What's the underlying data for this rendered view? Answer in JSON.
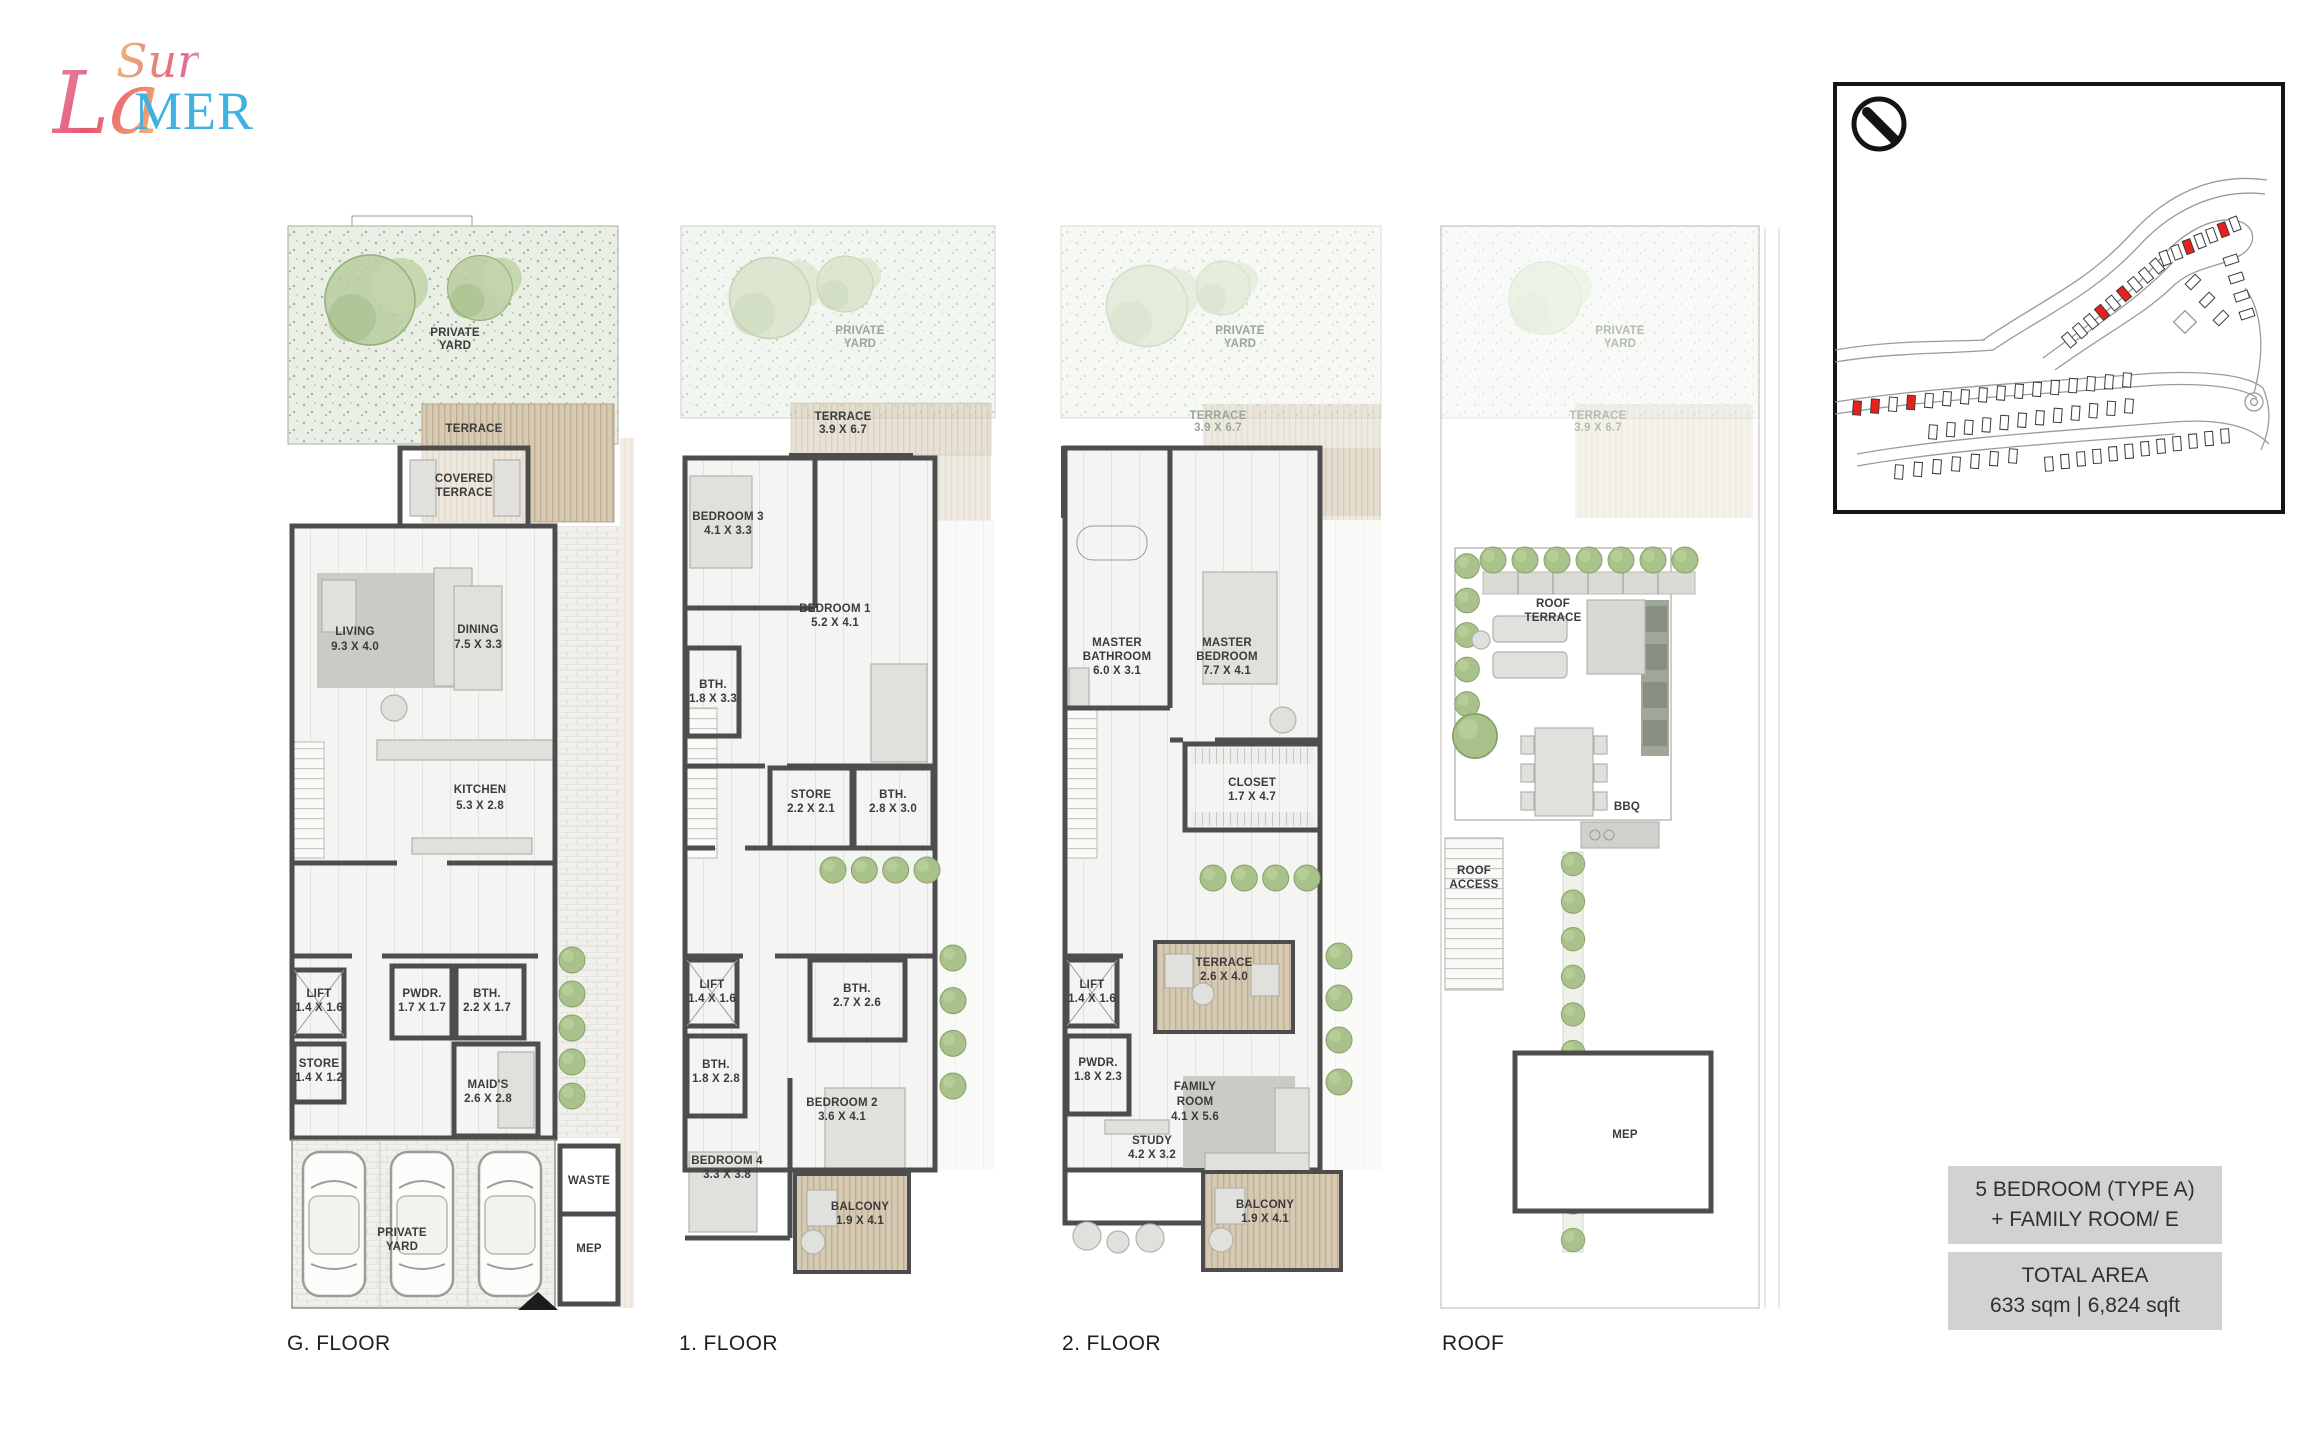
{
  "logo": {
    "sur": "Sur",
    "la": "La",
    "mer": "MER"
  },
  "plans": [
    {
      "floor_label": "G. FLOOR",
      "rooms": {
        "private_yard_top": {
          "l1": "PRIVATE",
          "l2": "YARD"
        },
        "terrace": {
          "l1": "TERRACE"
        },
        "covered_terrace": {
          "l1": "COVERED",
          "l2": "TERRACE"
        },
        "living": {
          "l1": "LIVING",
          "d": "9.3 X 4.0"
        },
        "dining": {
          "l1": "DINING",
          "d": "7.5 X 3.3"
        },
        "kitchen": {
          "l1": "KITCHEN",
          "d": "5.3 X 2.8"
        },
        "lift": {
          "l1": "LIFT",
          "d": "1.4 X 1.6"
        },
        "store": {
          "l1": "STORE",
          "d": "1.4 X 1.2"
        },
        "pwdr": {
          "l1": "PWDR.",
          "d": "1.7 X 1.7"
        },
        "bth": {
          "l1": "BTH.",
          "d": "2.2 X 1.7"
        },
        "maids": {
          "l1": "MAID'S",
          "d": "2.6 X 2.8"
        },
        "private_yard_garage": {
          "l1": "PRIVATE",
          "l2": "YARD"
        },
        "waste": {
          "l1": "WASTE"
        },
        "mep": {
          "l1": "MEP"
        }
      }
    },
    {
      "floor_label": "1. FLOOR",
      "rooms": {
        "private_yard": {
          "l1": "PRIVATE",
          "l2": "YARD"
        },
        "terrace": {
          "l1": "TERRACE",
          "d": "3.9 X 6.7"
        },
        "balcony_top": {
          "l1": "BALCONY",
          "d": "2.0 X 3.5"
        },
        "bedroom3": {
          "l1": "BEDROOM 3",
          "d": "4.1 X 3.3"
        },
        "bedroom1": {
          "l1": "BEDROOM 1",
          "d": "5.2 X 4.1"
        },
        "bth_a": {
          "l1": "BTH.",
          "d": "1.8 X 3.3"
        },
        "store": {
          "l1": "STORE",
          "d": "2.2 X 2.1"
        },
        "bth_b": {
          "l1": "BTH.",
          "d": "2.8 X 3.0"
        },
        "lift": {
          "l1": "LIFT",
          "d": "1.4 X 1.6"
        },
        "bth_c": {
          "l1": "BTH.",
          "d": "2.7 X 2.6"
        },
        "bth_d": {
          "l1": "BTH.",
          "d": "1.8 X 2.8"
        },
        "bedroom2": {
          "l1": "BEDROOM 2",
          "d": "3.6 X 4.1"
        },
        "bedroom4": {
          "l1": "BEDROOM 4",
          "d": "3.3 X 3.8"
        },
        "balcony_bottom": {
          "l1": "BALCONY",
          "d": "1.9 X 4.1"
        }
      }
    },
    {
      "floor_label": "2. FLOOR",
      "rooms": {
        "private_yard": {
          "l1": "PRIVATE",
          "l2": "YARD"
        },
        "terrace_top": {
          "l1": "TERRACE",
          "d": "3.9 X 6.7"
        },
        "balcony_top": {
          "l1": "BALCONY",
          "d": "2.0 X 7.2"
        },
        "master_bathroom": {
          "l1": "MASTER",
          "l2": "BATHROOM",
          "d": "6.0 X 3.1"
        },
        "master_bedroom": {
          "l1": "MASTER",
          "l2": "BEDROOM",
          "d": "7.7 X 4.1"
        },
        "closet": {
          "l1": "CLOSET",
          "d": "1.7 X 4.7"
        },
        "lift": {
          "l1": "LIFT",
          "d": "1.4 X 1.6"
        },
        "terrace_mid": {
          "l1": "TERRACE",
          "d": "2.6 X 4.0"
        },
        "pwdr": {
          "l1": "PWDR.",
          "d": "1.8 X 2.3"
        },
        "family_room": {
          "l1": "FAMILY",
          "l2": "ROOM",
          "d": "4.1 X 5.6"
        },
        "study": {
          "l1": "STUDY",
          "d": "4.2 X 3.2"
        },
        "balcony_bottom": {
          "l1": "BALCONY",
          "d": "1.9 X 4.1"
        }
      }
    },
    {
      "floor_label": "ROOF",
      "rooms": {
        "private_yard": {
          "l1": "PRIVATE",
          "l2": "YARD"
        },
        "terrace_top": {
          "l1": "TERRACE",
          "d": "3.9 X 6.7"
        },
        "roof_terrace": {
          "l1": "ROOF",
          "l2": "TERRACE"
        },
        "bbq": {
          "l1": "BBQ"
        },
        "roof_access": {
          "l1": "ROOF",
          "l2": "ACCESS"
        },
        "mep": {
          "l1": "MEP"
        }
      }
    }
  ],
  "info_boxes": {
    "unit_type_line1": "5 BEDROOM (TYPE A)",
    "unit_type_line2": "+ FAMILY ROOM/ E",
    "total_area_label": "TOTAL AREA",
    "total_area_value": "633 sqm | 6,824 sqft"
  },
  "site_map": {
    "highlight_color": "#e8211d",
    "highlighted_units": 8
  },
  "colors": {
    "logo_blue": "#41b1e2",
    "logo_pink": "#e4607e",
    "logo_orange": "#ecb079",
    "wall": "#4d4d4d",
    "yard_green": "#e9efe4",
    "wood": "#d7cab3",
    "info_box_bg": "#d2d2d2",
    "map_red": "#e8211d"
  }
}
